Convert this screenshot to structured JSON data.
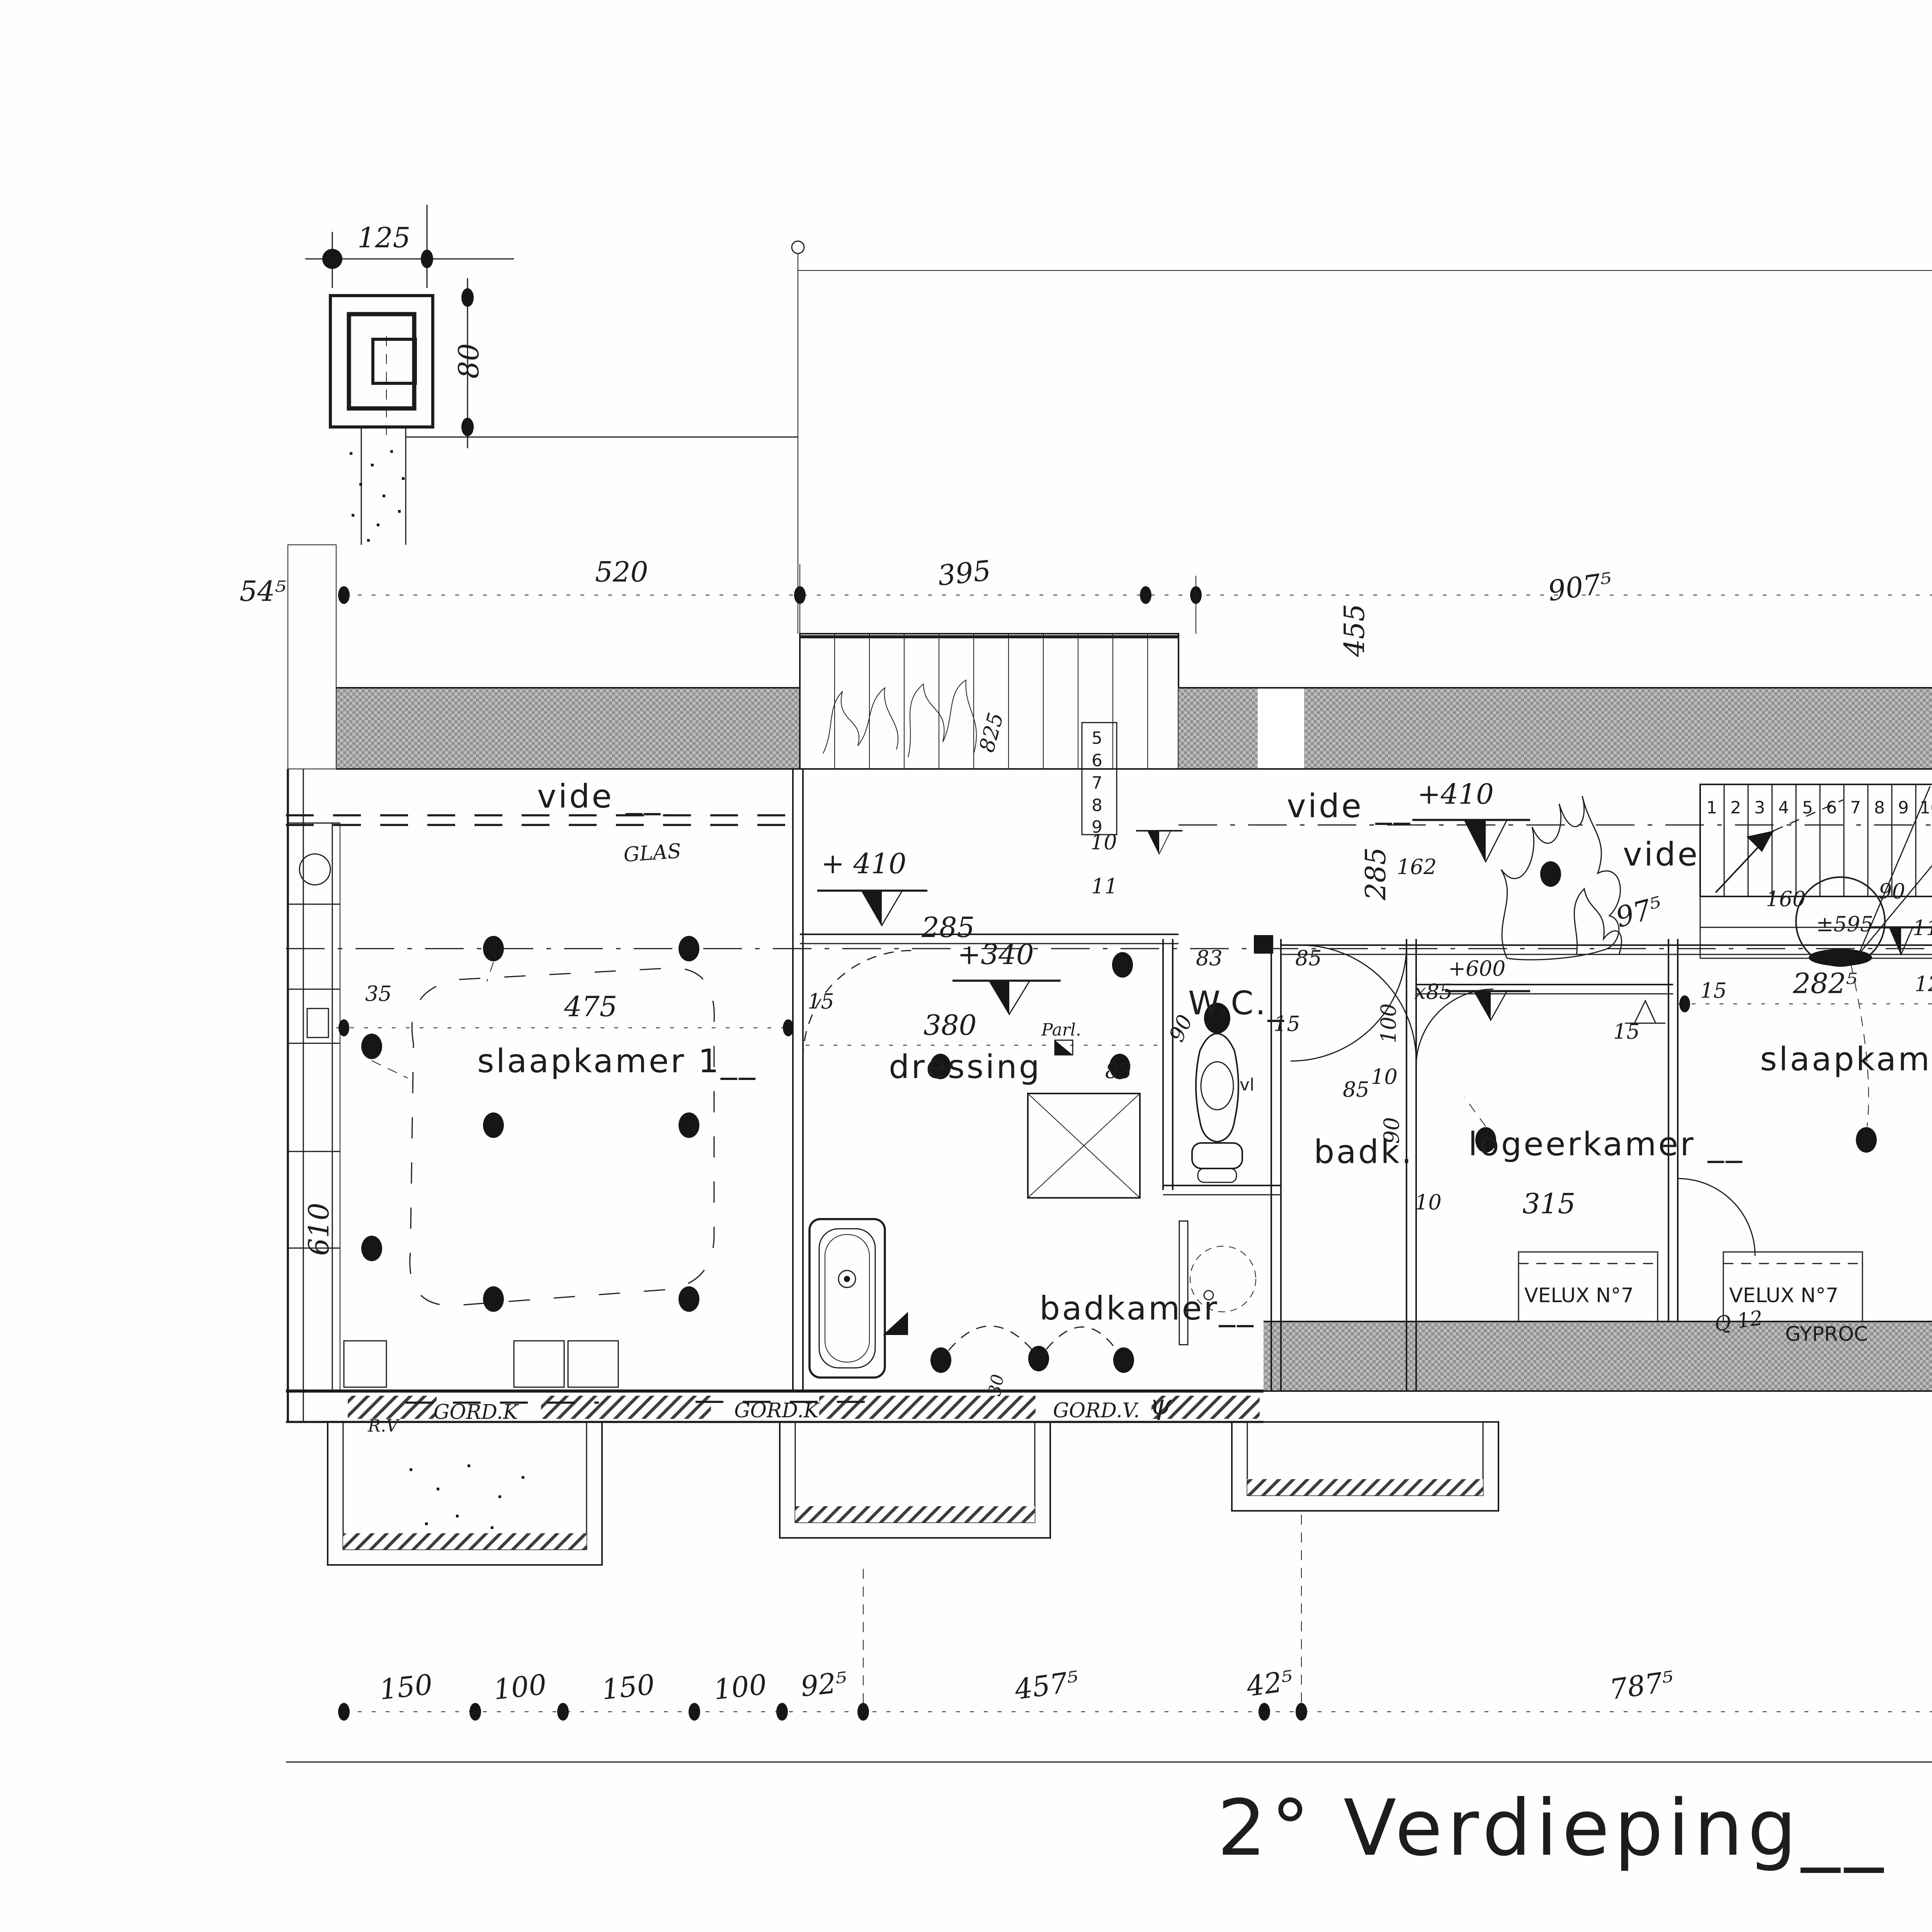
{
  "title": "2° Verdieping__",
  "colors": {
    "paper": "#fefefd",
    "ink": "#1c1c1c",
    "wall_gray": "#a6a6a6",
    "glass_gray": "#dedede"
  },
  "rooms": {
    "vide_left": "vide __",
    "vide_mid": "vide __",
    "vide_right": "vide",
    "slaapkamer1": "slaapkamer 1__",
    "dressing": "dressing",
    "badkamer": "badkamer__",
    "wc": "W.C._",
    "badk": "badk.",
    "logeerkamer": "logeerkamer __",
    "slaapkamer2": "slaapkamer 2_"
  },
  "levels": {
    "l410a": "+ 410",
    "l340": "+340",
    "l410b": "+410",
    "l600": "+600",
    "lx85": "x85",
    "l595": "±595"
  },
  "dims": {
    "top": {
      "a": "520",
      "b": "395",
      "c": "907⁵"
    },
    "chimney": {
      "w": "125",
      "h": "80"
    },
    "bottom": {
      "a": "150",
      "b": "100",
      "c": "150",
      "d": "100",
      "e": "92⁵",
      "f": "457⁵",
      "g": "42⁵",
      "h": "787⁵"
    },
    "small": {
      "s475": "475",
      "s380": "380",
      "s610": "610",
      "s35": "35",
      "s54": "54⁵",
      "s455": "455",
      "s285a": "285",
      "s285b": "285",
      "s825": "825",
      "s975": "97⁵",
      "s160": "160",
      "s90a": "90",
      "s90b": "90",
      "s90c": "90",
      "s83a": "83",
      "s83b": "83",
      "s85a": "85",
      "s85b": "85",
      "s15a": "15",
      "s15b": "15",
      "s15c": "15",
      "s15d": "15",
      "s100": "100",
      "s162": "162",
      "s10a": "10",
      "s10b": "10",
      "s10c": "10",
      "s11a": "11",
      "s11b": "11",
      "s12": "12",
      "s315": "315",
      "s282": "282⁵",
      "s30": "30"
    }
  },
  "stairs": {
    "treads": [
      "1",
      "2",
      "3",
      "4",
      "5",
      "6",
      "7",
      "8",
      "9",
      "10"
    ],
    "lower": [
      "5",
      "6",
      "7",
      "8",
      "9"
    ],
    "n11": "11",
    "n12": "12"
  },
  "notes": {
    "glas": "GLAS",
    "parl": "Parl.",
    "gordk_a": "GORD.K",
    "gordk_b": "GORD.K",
    "gordv": "GORD.V.",
    "rv": "R.V",
    "psi": "ψ",
    "vl": "vl",
    "velux_a": "VELUX N°7",
    "velux_b": "VELUX N°7",
    "gyproc": "GYPROC",
    "q12": "Q 12",
    "margin_a": "15/5/10",
    "margin_b": "NOK."
  }
}
